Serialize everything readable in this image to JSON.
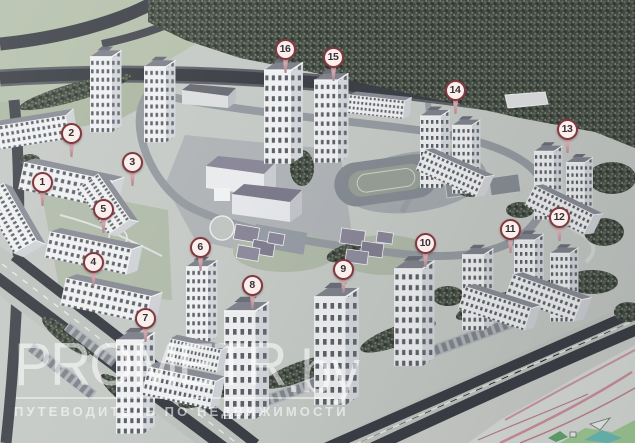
{
  "scene": {
    "description": "Aerial photograph of an architectural scale model of a residential district with numbered building pins",
    "watermark": {
      "brand": "PROMETR",
      "domain": ".by",
      "tagline": "ПУТЕВОДИТЕЛЬ ПО НЕДВИЖИМОСТИ"
    },
    "markers": [
      {
        "label": "1",
        "x": 42,
        "y": 182
      },
      {
        "label": "2",
        "x": 71,
        "y": 133
      },
      {
        "label": "3",
        "x": 132,
        "y": 162
      },
      {
        "label": "4",
        "x": 93,
        "y": 262
      },
      {
        "label": "5",
        "x": 103,
        "y": 209
      },
      {
        "label": "6",
        "x": 200,
        "y": 247
      },
      {
        "label": "7",
        "x": 145,
        "y": 318
      },
      {
        "label": "8",
        "x": 252,
        "y": 285
      },
      {
        "label": "9",
        "x": 343,
        "y": 269
      },
      {
        "label": "10",
        "x": 425,
        "y": 243
      },
      {
        "label": "11",
        "x": 510,
        "y": 229
      },
      {
        "label": "12",
        "x": 559,
        "y": 217
      },
      {
        "label": "13",
        "x": 567,
        "y": 129
      },
      {
        "label": "14",
        "x": 455,
        "y": 90
      },
      {
        "label": "15",
        "x": 333,
        "y": 57
      },
      {
        "label": "16",
        "x": 285,
        "y": 49
      }
    ],
    "colors": {
      "pin_ring": "#83383f",
      "pin_fill": "#f9efec",
      "trees": "#454c44",
      "road_dark": "#3d4147",
      "ground": "#c6cac6",
      "grass": "#b6c1ad",
      "roof": "#83868f",
      "plan_green": "#a3cf97",
      "plan_teal": "#6cc0ba",
      "plan_pink": "#cf939e"
    }
  }
}
